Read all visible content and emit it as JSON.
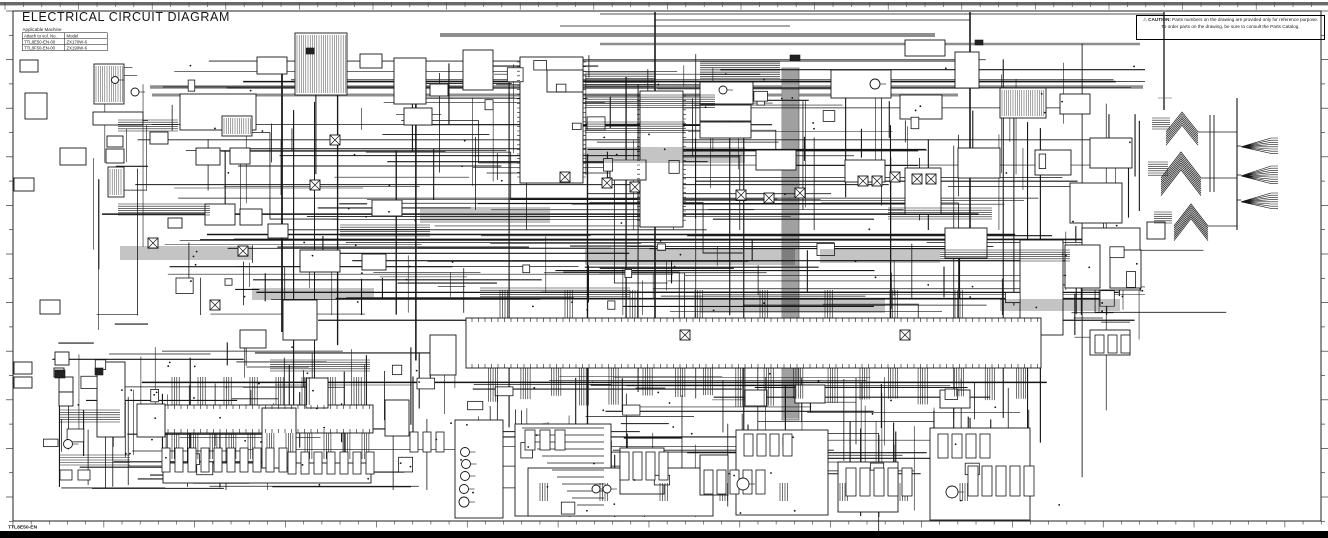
{
  "header": {
    "title": "ELECTRICAL CIRCUIT DIAGRAM",
    "applicable_machine_label": "Applicable Machine",
    "vol_table": {
      "col1_header": "Attach to vol. No.",
      "col2_header": "Model",
      "rows": [
        {
          "vol_no": "TTL8E50-EN-00",
          "model": "ZX170W-6"
        },
        {
          "vol_no": "TTL8F50-EN-00",
          "model": "ZX190W-6"
        }
      ]
    }
  },
  "caution": {
    "warning_icon": "⚠",
    "label": "CAUTION:",
    "line1": "Parts numbers on the drawing are provided only for reference purpose.",
    "line2": "To order parts on the drawing, be sure to consult the Parts Catalog."
  },
  "footer": {
    "drawing_code": "TTL8E50-EN"
  },
  "colors": {
    "line": "#161616",
    "bus": "#8e8e8e",
    "band": "#b9b9b9",
    "ruler": "#5a5a5a",
    "frame": "#222222",
    "paper": "#ffffff",
    "bottom_bar": "#000000"
  }
}
